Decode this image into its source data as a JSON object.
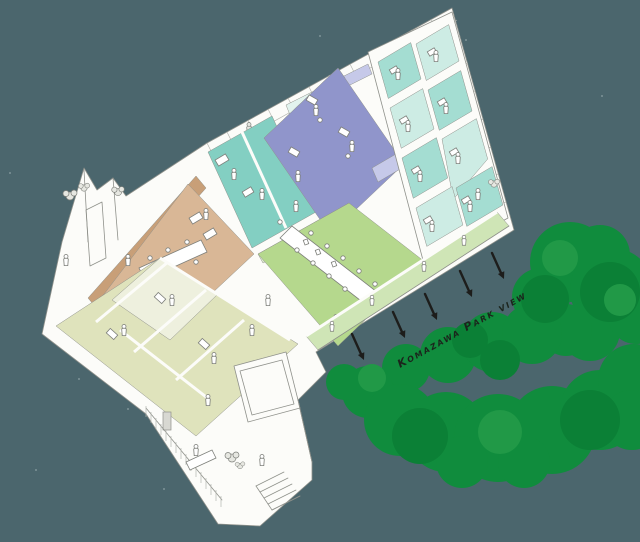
{
  "caption": {
    "text": "Komazawa Park view"
  },
  "arrows": {
    "count": 5,
    "color": "#1d1d1b",
    "direction": "toward-park"
  },
  "park": {
    "tree_colors": [
      "#108c3d",
      "#0b8036",
      "#219947"
    ]
  },
  "zones": [
    {
      "name": "private-rooms-teal",
      "floor_color": "#cdece4"
    },
    {
      "name": "workroom-teal",
      "floor_color": "#83cfc2"
    },
    {
      "name": "studio-purple",
      "floor_color": "#9095cb"
    },
    {
      "name": "meeting-room-green",
      "floor_color": "#b5d88d"
    },
    {
      "name": "park-side-veranda",
      "floor_color": "#cfe5b6"
    },
    {
      "name": "dining-room-tan",
      "floor_color": "#d9b796"
    },
    {
      "name": "small-offices-olive",
      "floor_color": "#dfe3bc"
    },
    {
      "name": "entrance-court-white",
      "floor_color": "#fcfcf9"
    }
  ],
  "palette": {
    "bg": "#4b666d",
    "line": "#8f918b",
    "line-soft": "#b4b6b0",
    "wall": "#fcfcf9",
    "figure": "#7d7f7a",
    "teal-light": "#cdece4",
    "teal-mid": "#a4ddd2",
    "teal-strong": "#83cfc2",
    "teal-wall": "#e2f3ee",
    "purple-floor": "#9095cb",
    "purple-wall": "#c6c9e9",
    "green-floor": "#b5d88d",
    "green-veranda": "#cfe5b6",
    "green-wall": "#e1ecd2",
    "tan-floor": "#d9b796",
    "tan-wall": "#c89f78",
    "olive-floor": "#dfe3bc",
    "olive-wall": "#eef0de",
    "park-green": "#108c3d",
    "park-green-dark": "#0b8036",
    "park-green-light": "#219947",
    "arrow": "#1d1d1b",
    "caption": "#1b241c",
    "speck": "#a7b8bb"
  }
}
